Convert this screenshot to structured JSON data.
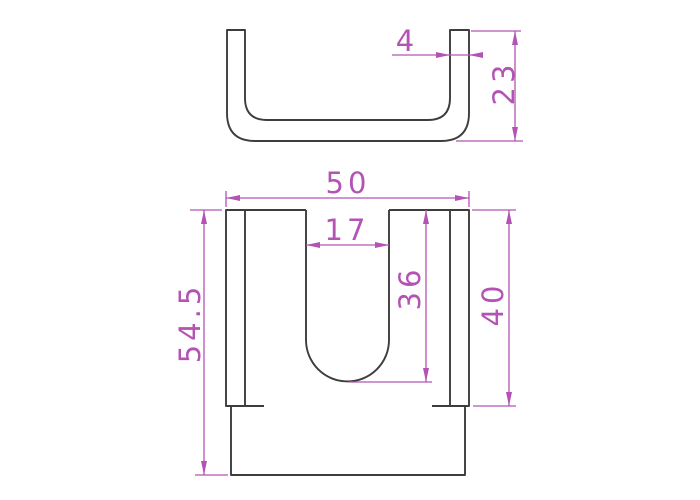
{
  "colors": {
    "background": "#ffffff",
    "part_line": "#3d3d3d",
    "dimension": "#b353b3"
  },
  "views": {
    "top": {
      "name": "top-profile-view",
      "dims": {
        "wall_thickness": {
          "label": "4"
        },
        "profile_height": {
          "label": "23"
        }
      }
    },
    "front": {
      "name": "front-view",
      "dims": {
        "overall_width": {
          "label": "50"
        },
        "slot_width": {
          "label": "17"
        },
        "slot_depth": {
          "label": "36"
        },
        "side_height": {
          "label": "40"
        },
        "total_height": {
          "label": "54.5"
        }
      }
    }
  }
}
